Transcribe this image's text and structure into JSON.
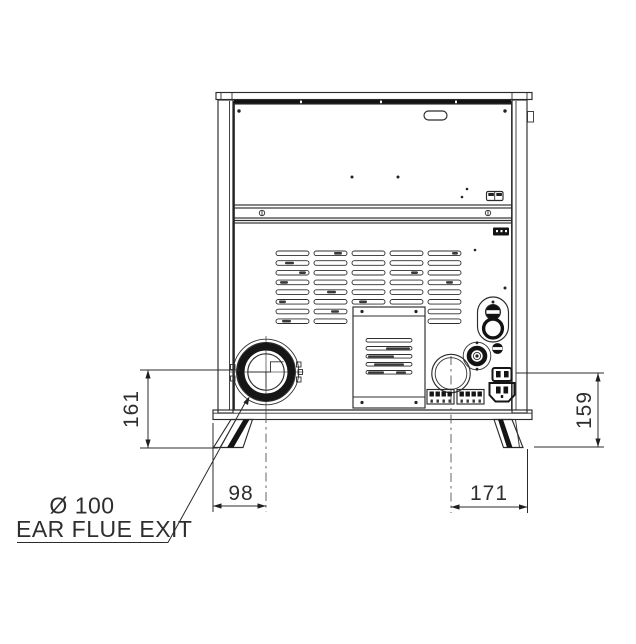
{
  "drawing": {
    "callout": {
      "line1": "Ø 100",
      "line2": "EAR FLUE EXIT"
    },
    "dims": {
      "left_vertical": "161",
      "right_vertical": "159",
      "bottom_left": "98",
      "bottom_right": "171"
    },
    "colors": {
      "line": "#2b2b2b",
      "dark_fill": "#141414",
      "background": "#ffffff"
    }
  }
}
